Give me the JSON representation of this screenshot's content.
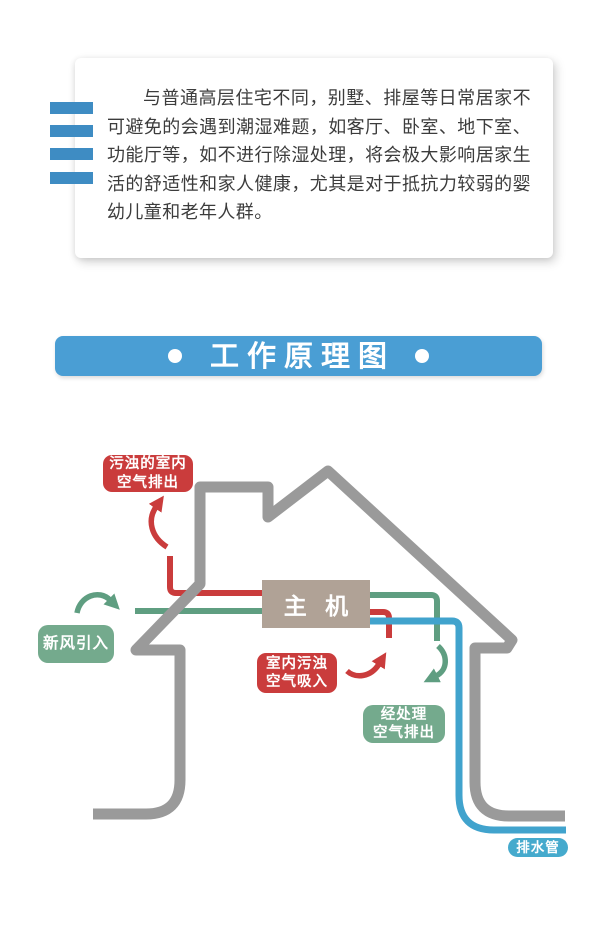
{
  "intro": {
    "text": "与普通高层住宅不同，别墅、排屋等日常居家不可避免的会遇到潮湿难题，如客厅、卧室、地下室、功能厅等，如不进行除湿处理，将会极大影响居家生活的舒适性和家人健康，尤其是对于抵抗力较弱的婴幼儿童和老年人群。"
  },
  "banner": {
    "title": "工作原理图"
  },
  "diagram": {
    "main_unit": "主 机",
    "labels": {
      "exhaust": {
        "line1": "污浊的室内",
        "line2": "空气排出"
      },
      "fresh": {
        "text": "新风引入"
      },
      "suction": {
        "line1": "室内污浊",
        "line2": "空气吸入"
      },
      "treated": {
        "line1": "经处理",
        "line2": "空气排出"
      },
      "drain": {
        "text": "排水管"
      }
    },
    "colors": {
      "house_outline": "#9a9a9a",
      "red_flow": "#ca3c3c",
      "green_flow": "#5f9e81",
      "green_label": "#74aa8d",
      "blue_pipe": "#41a3cd",
      "blue_label": "#45aacd",
      "unit_box": "#b0a296",
      "banner_blue": "#4a9ed4",
      "bar_blue": "#3e8cc3"
    }
  }
}
